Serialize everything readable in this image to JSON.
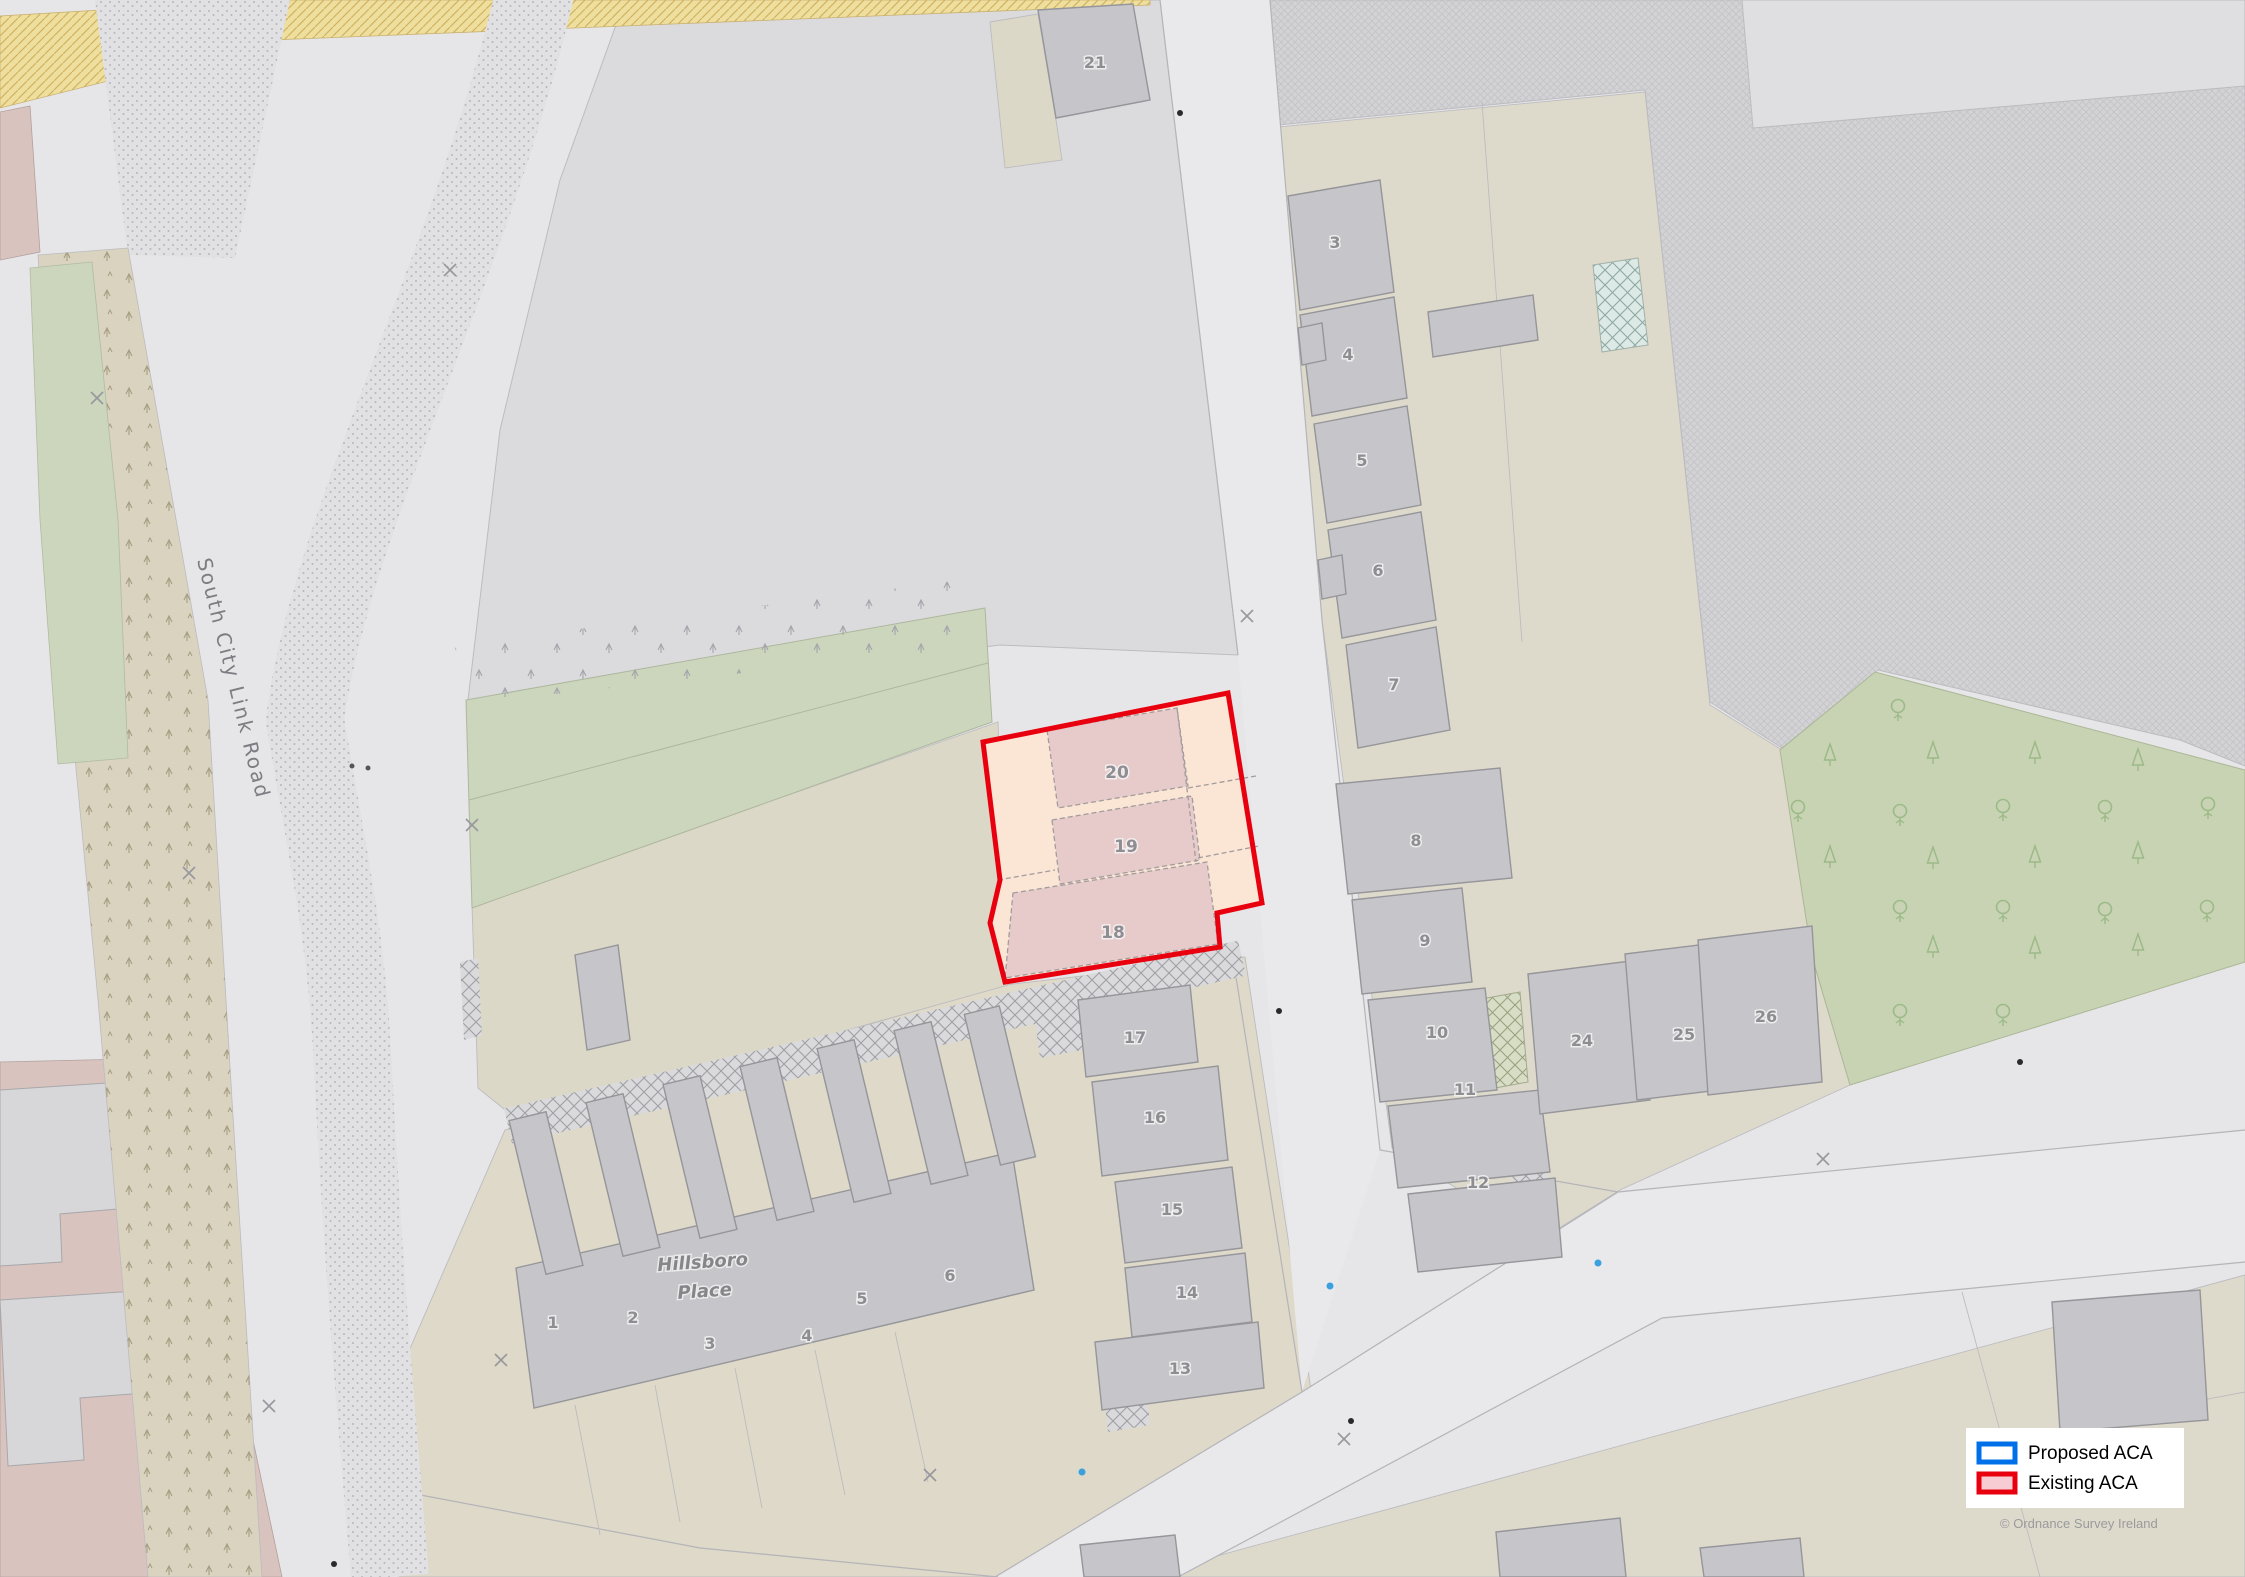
{
  "map": {
    "title_labels": {
      "road": "South City Link Road",
      "place_line1": "Hillsboro",
      "place_line2": "Place"
    },
    "aca": {
      "numbers": [
        "20",
        "19",
        "18"
      ]
    },
    "buildings": {
      "north": "21",
      "right_column": [
        "3",
        "4",
        "5",
        "6",
        "7",
        "8",
        "9",
        "10",
        "11",
        "12"
      ],
      "lower_row": [
        "24",
        "25",
        "26"
      ],
      "mid_column": [
        "17",
        "16",
        "15",
        "14",
        "13"
      ],
      "hillsboro": [
        "1",
        "2",
        "3",
        "4",
        "5",
        "6"
      ]
    }
  },
  "legend": {
    "items": [
      {
        "label": "Proposed ACA",
        "border": "#0070e8",
        "fill": "#ffffff"
      },
      {
        "label": "Existing ACA",
        "border": "#e8000f",
        "fill": "#f7cdd3"
      }
    ]
  },
  "attribution": "©  Ordnance Survey Ireland",
  "colors": {
    "existing_aca_outline": "#e8000f",
    "existing_aca_yard": "#fbe5d5",
    "existing_aca_building": "#e7cbcb",
    "building_gray": "#c6c6ca",
    "green_strip": "#ccd6bc",
    "tree_area": "#c8d3b4",
    "beige_plot": "#dedacb",
    "yellow_road_strip": "#eedf9f"
  }
}
